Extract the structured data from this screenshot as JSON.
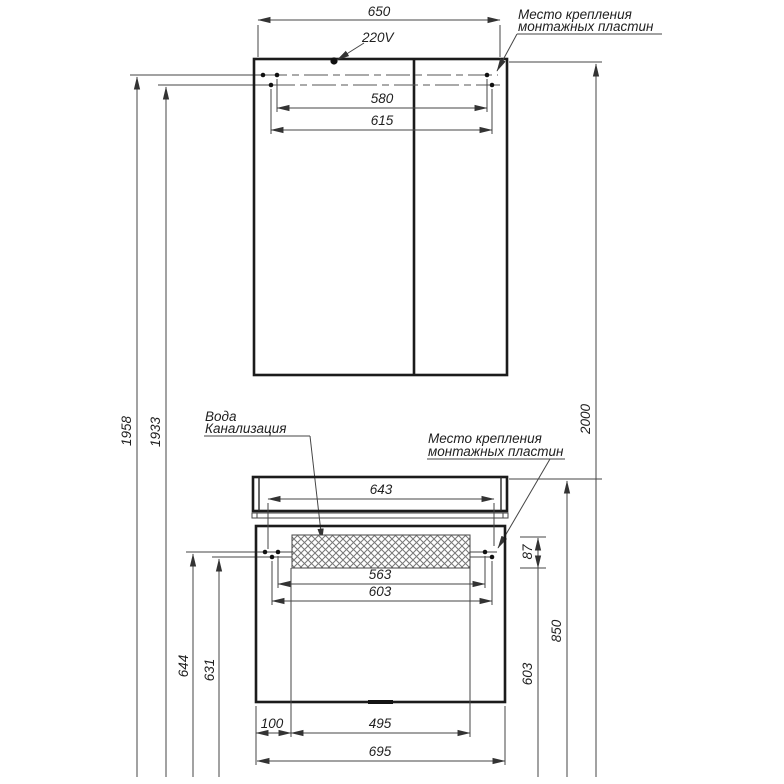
{
  "labels": {
    "power": "220V",
    "mounting_top": {
      "line1": "Место крепления",
      "line2": "монтажных пластин"
    },
    "mounting_bottom": {
      "line1": "Место крепления",
      "line2": "монтажных пластин"
    },
    "water": "Вода",
    "sewer": "Канализация"
  },
  "dimensions": {
    "mirror_width": "650",
    "mirror_holes_inner": "580",
    "mirror_holes_outer": "615",
    "height_left_outer": "1958",
    "height_left_inner": "1933",
    "height_right_total": "2000",
    "vanity_top_width": "643",
    "vanity_holes_inner": "563",
    "vanity_holes_outer": "603",
    "plate_offset": "87",
    "height_to_top": "850",
    "height_to_plates": "603",
    "height_plate_row_outer": "644",
    "height_plate_row_inner": "631",
    "bottom_offset": "100",
    "opening_width": "495",
    "vanity_bottom_width": "695"
  }
}
